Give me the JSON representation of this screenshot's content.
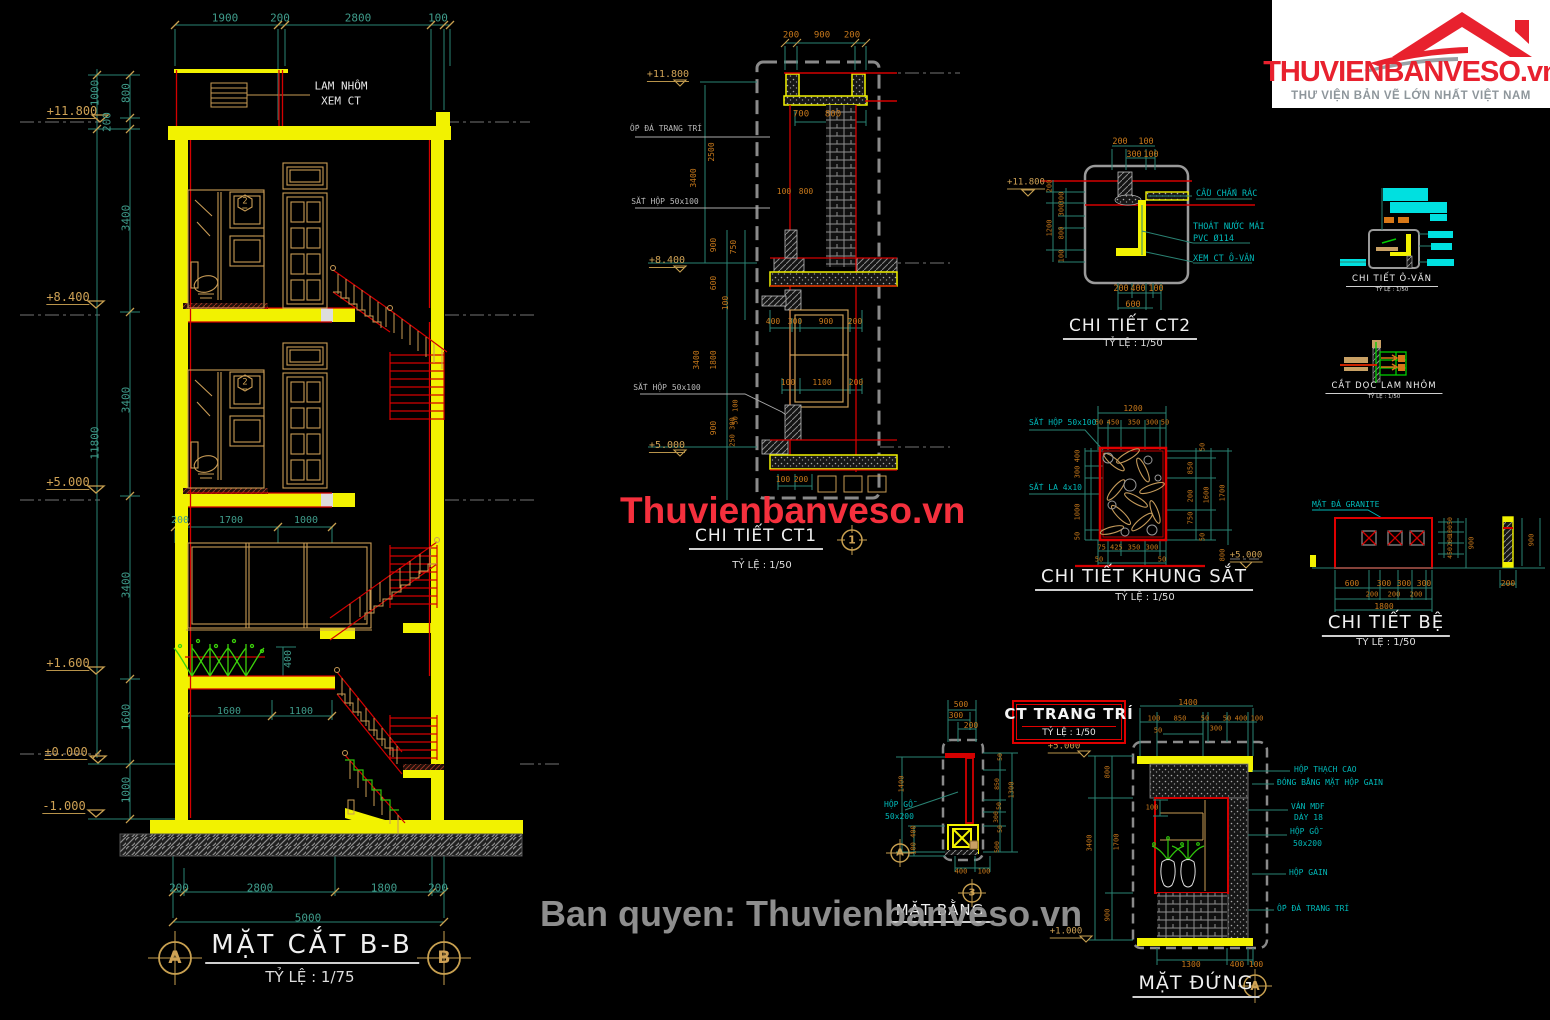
{
  "logo": {
    "brand": "THUVIENBANVESO.vn",
    "tagline": "THƯ VIỆN BẢN VẼ LỚN NHẤT VIỆT NAM"
  },
  "watermarks": {
    "center": "Thuvienbanveso.vn",
    "bottom": "Ban quyen: Thuvienbanveso.vn"
  },
  "colors": {
    "dim_teal": "#3f9c8b",
    "dim_orange": "#c8791b",
    "elevation_tan": "#cfa255",
    "note_cyan": "#00b9b9",
    "structure_yellow": "#f2f200",
    "line_red": "#d40000",
    "brand_red": "#e8212e"
  },
  "drawings": {
    "mat_cat_bb": {
      "title": "MẶT CẮT B-B",
      "scale": "TỶ LỆ : 1/75",
      "grid_a": "A",
      "grid_b": "B"
    },
    "ct1": {
      "title": "CHI TIẾT CT1",
      "scale": "TỶ LỆ : 1/50",
      "marker": "1"
    },
    "ct2": {
      "title": "CHI TIẾT CT2",
      "scale": "TỶ LỆ : 1/50"
    },
    "o_vang": {
      "title": "CHI TIẾT Ô-VĂN",
      "scale": "TỶ LỆ : 1/50"
    },
    "lam_nhom": {
      "title": "CẮT DỌC LAM NHÔM",
      "scale": "TỶ LỆ : 1/50"
    },
    "khung_sat": {
      "title": "CHI TIẾT KHUNG SẮT",
      "scale": "TỶ LỆ : 1/50"
    },
    "be": {
      "title": "CHI TIẾT BỆ",
      "scale": "TỶ LỆ : 1/50"
    },
    "trang_tri": {
      "title": "CT TRANG TRÍ",
      "scale": "TỶ LỆ : 1/50"
    },
    "mat_bang": {
      "title": "MẶT BẰNG",
      "bubble_a": "A",
      "bubble_3": "3"
    },
    "mat_dung": {
      "title": "MẶT ĐỨNG",
      "bubble_a": "A"
    }
  },
  "annotations": [
    {
      "t": "1900",
      "x": 225,
      "y": 18,
      "s": 11
    },
    {
      "t": "200",
      "x": 280,
      "y": 18,
      "s": 11
    },
    {
      "t": "2800",
      "x": 358,
      "y": 18,
      "s": 11
    },
    {
      "t": "100",
      "x": 438,
      "y": 18,
      "s": 11
    },
    {
      "t": "1000",
      "x": 95,
      "y": 93,
      "s": 11,
      "r": -90
    },
    {
      "t": "800",
      "x": 126,
      "y": 93,
      "s": 11,
      "r": -90
    },
    {
      "t": "200",
      "x": 107,
      "y": 122,
      "s": 11,
      "r": -90
    },
    {
      "t": "3400",
      "x": 126,
      "y": 218,
      "s": 11,
      "r": -90
    },
    {
      "t": "3400",
      "x": 126,
      "y": 400,
      "s": 11,
      "r": -90
    },
    {
      "t": "11800",
      "x": 95,
      "y": 443,
      "s": 11,
      "r": -90
    },
    {
      "t": "3400",
      "x": 126,
      "y": 585,
      "s": 11,
      "r": -90
    },
    {
      "t": "1600",
      "x": 126,
      "y": 717,
      "s": 11,
      "r": -90
    },
    {
      "t": "1000",
      "x": 126,
      "y": 790,
      "s": 11,
      "r": -90
    },
    {
      "t": "+11.800",
      "x": 72,
      "y": 112,
      "c": "e",
      "s": 12
    },
    {
      "t": "+8.400",
      "x": 68,
      "y": 298,
      "c": "e",
      "s": 12
    },
    {
      "t": "+5.000",
      "x": 68,
      "y": 483,
      "c": "e",
      "s": 12
    },
    {
      "t": "+1.600",
      "x": 68,
      "y": 664,
      "c": "e",
      "s": 12
    },
    {
      "t": "±0.000",
      "x": 66,
      "y": 753,
      "c": "e",
      "s": 12
    },
    {
      "t": "-1.000",
      "x": 64,
      "y": 807,
      "c": "e",
      "s": 12
    },
    {
      "t": "LAM NHÔM",
      "x": 341,
      "y": 86,
      "c": "w",
      "s": 11
    },
    {
      "t": "XEM CT",
      "x": 341,
      "y": 101,
      "c": "w",
      "s": 11
    },
    {
      "t": "200",
      "x": 180,
      "y": 521
    },
    {
      "t": "1700",
      "x": 231,
      "y": 521
    },
    {
      "t": "1000",
      "x": 306,
      "y": 521
    },
    {
      "t": "400",
      "x": 289,
      "y": 659,
      "r": -90
    },
    {
      "t": "1600",
      "x": 229,
      "y": 712
    },
    {
      "t": "1100",
      "x": 301,
      "y": 712
    },
    {
      "t": "200",
      "x": 179,
      "y": 888,
      "s": 11
    },
    {
      "t": "2800",
      "x": 260,
      "y": 888,
      "s": 11
    },
    {
      "t": "1800",
      "x": 384,
      "y": 888,
      "s": 11
    },
    {
      "t": "200",
      "x": 438,
      "y": 888,
      "s": 11
    },
    {
      "t": "5000",
      "x": 308,
      "y": 918,
      "s": 11
    },
    {
      "t": "2",
      "x": 245,
      "y": 203,
      "c": "e",
      "s": 9
    },
    {
      "t": "2",
      "x": 245,
      "y": 384,
      "c": "e",
      "s": 9
    },
    {
      "t": "200",
      "x": 791,
      "y": 36,
      "c": "o",
      "s": 9
    },
    {
      "t": "900",
      "x": 822,
      "y": 36,
      "c": "o",
      "s": 9
    },
    {
      "t": "200",
      "x": 852,
      "y": 36,
      "c": "o",
      "s": 9
    },
    {
      "t": "+11.800",
      "x": 668,
      "y": 76,
      "c": "e",
      "s": 10
    },
    {
      "t": "ỐP ĐÁ TRANG TRÍ",
      "x": 666,
      "y": 129,
      "c": "g",
      "s": 8
    },
    {
      "t": "700",
      "x": 801,
      "y": 115,
      "c": "o",
      "s": 9
    },
    {
      "t": "800",
      "x": 833,
      "y": 115,
      "c": "o",
      "s": 9
    },
    {
      "t": "100",
      "x": 784,
      "y": 192,
      "c": "o",
      "s": 8
    },
    {
      "t": "800",
      "x": 806,
      "y": 192,
      "c": "o",
      "s": 8
    },
    {
      "t": "2500",
      "x": 712,
      "y": 152,
      "c": "o",
      "s": 8,
      "r": -90
    },
    {
      "t": "3400",
      "x": 694,
      "y": 178,
      "c": "o",
      "s": 8,
      "r": -90
    },
    {
      "t": "SẮT HỘP 50x100",
      "x": 665,
      "y": 202,
      "c": "g",
      "s": 8
    },
    {
      "t": "900",
      "x": 714,
      "y": 245,
      "c": "o",
      "s": 8,
      "r": -90
    },
    {
      "t": "750",
      "x": 734,
      "y": 247,
      "c": "o",
      "s": 8,
      "r": -90
    },
    {
      "t": "+8.400",
      "x": 667,
      "y": 262,
      "c": "e",
      "s": 10
    },
    {
      "t": "600",
      "x": 714,
      "y": 283,
      "c": "o",
      "s": 8,
      "r": -90
    },
    {
      "t": "100",
      "x": 726,
      "y": 303,
      "c": "o",
      "s": 8,
      "r": -90
    },
    {
      "t": "400",
      "x": 773,
      "y": 322,
      "c": "o",
      "s": 8
    },
    {
      "t": "300",
      "x": 795,
      "y": 322,
      "c": "o",
      "s": 8
    },
    {
      "t": "900",
      "x": 826,
      "y": 322,
      "c": "o",
      "s": 8
    },
    {
      "t": "200",
      "x": 855,
      "y": 322,
      "c": "o",
      "s": 8
    },
    {
      "t": "3400",
      "x": 697,
      "y": 360,
      "c": "o",
      "s": 8,
      "r": -90
    },
    {
      "t": "1800",
      "x": 714,
      "y": 360,
      "c": "o",
      "s": 8,
      "r": -90
    },
    {
      "t": "SẮT HỘP 50x100",
      "x": 667,
      "y": 388,
      "c": "g",
      "s": 8
    },
    {
      "t": "100",
      "x": 788,
      "y": 383,
      "c": "o",
      "s": 8
    },
    {
      "t": "1100",
      "x": 822,
      "y": 383,
      "c": "o",
      "s": 8
    },
    {
      "t": "200",
      "x": 856,
      "y": 383,
      "c": "o",
      "s": 8
    },
    {
      "t": "50 100",
      "x": 736,
      "y": 412,
      "c": "o",
      "s": 7,
      "r": -90
    },
    {
      "t": "900",
      "x": 714,
      "y": 428,
      "c": "o",
      "s": 8,
      "r": -90
    },
    {
      "t": "250 300",
      "x": 733,
      "y": 432,
      "c": "o",
      "s": 7,
      "r": -90
    },
    {
      "t": "+5.000",
      "x": 667,
      "y": 447,
      "c": "e",
      "s": 10
    },
    {
      "t": "100",
      "x": 783,
      "y": 480,
      "c": "o",
      "s": 8
    },
    {
      "t": "200",
      "x": 801,
      "y": 480,
      "c": "o",
      "s": 8
    },
    {
      "t": "200",
      "x": 1120,
      "y": 142,
      "c": "o",
      "s": 8.5
    },
    {
      "t": "100",
      "x": 1146,
      "y": 142,
      "c": "o",
      "s": 8.5
    },
    {
      "t": "300",
      "x": 1134,
      "y": 155,
      "c": "o",
      "s": 8.5
    },
    {
      "t": "100",
      "x": 1151,
      "y": 155,
      "c": "o",
      "s": 8.5
    },
    {
      "t": "+11.800",
      "x": 1026,
      "y": 184,
      "c": "e",
      "s": 9
    },
    {
      "t": "200",
      "x": 1050,
      "y": 186,
      "c": "o",
      "s": 7,
      "r": -90
    },
    {
      "t": "300",
      "x": 1062,
      "y": 198,
      "c": "o",
      "s": 7,
      "r": -90
    },
    {
      "t": "300",
      "x": 1062,
      "y": 210,
      "c": "o",
      "s": 7,
      "r": -90
    },
    {
      "t": "1200",
      "x": 1050,
      "y": 228,
      "c": "o",
      "s": 7,
      "r": -90
    },
    {
      "t": "800",
      "x": 1062,
      "y": 233,
      "c": "o",
      "s": 7,
      "r": -90
    },
    {
      "t": "100",
      "x": 1062,
      "y": 256,
      "c": "o",
      "s": 7,
      "r": -90
    },
    {
      "t": "200",
      "x": 1121,
      "y": 289,
      "c": "o",
      "s": 8.5
    },
    {
      "t": "400",
      "x": 1138,
      "y": 289,
      "c": "o",
      "s": 8.5
    },
    {
      "t": "100",
      "x": 1156,
      "y": 289,
      "c": "o",
      "s": 8.5
    },
    {
      "t": "600",
      "x": 1133,
      "y": 305,
      "c": "o",
      "s": 8.5
    },
    {
      "t": "CẦU CHẮN RÁC",
      "x": 1196,
      "y": 194,
      "c": "n",
      "s": 8.5,
      "a": "l"
    },
    {
      "t": "THOÁT NƯỚC MÁI",
      "x": 1193,
      "y": 227,
      "c": "n",
      "s": 8.5,
      "a": "l"
    },
    {
      "t": "PVC Ø114",
      "x": 1193,
      "y": 239,
      "c": "n",
      "s": 8.5,
      "a": "l"
    },
    {
      "t": "XEM CT Ô-VĂN",
      "x": 1193,
      "y": 259,
      "c": "n",
      "s": 8.5,
      "a": "l"
    },
    {
      "t": "1200",
      "x": 1133,
      "y": 409,
      "c": "o",
      "s": 8
    },
    {
      "t": "50",
      "x": 1099,
      "y": 423,
      "c": "o",
      "s": 7
    },
    {
      "t": "450",
      "x": 1113,
      "y": 423,
      "c": "o",
      "s": 7
    },
    {
      "t": "350",
      "x": 1134,
      "y": 423,
      "c": "o",
      "s": 7
    },
    {
      "t": "300",
      "x": 1152,
      "y": 423,
      "c": "o",
      "s": 7
    },
    {
      "t": "50",
      "x": 1165,
      "y": 423,
      "c": "o",
      "s": 7
    },
    {
      "t": "SẮT HỘP 50x100",
      "x": 1029,
      "y": 423,
      "c": "n",
      "s": 8,
      "a": "l"
    },
    {
      "t": "SẮT LA 4x10",
      "x": 1029,
      "y": 488,
      "c": "n",
      "s": 8,
      "a": "l"
    },
    {
      "t": "400",
      "x": 1078,
      "y": 456,
      "c": "o",
      "s": 7,
      "r": -90
    },
    {
      "t": "300",
      "x": 1078,
      "y": 472,
      "c": "o",
      "s": 7,
      "r": -90
    },
    {
      "t": "1000",
      "x": 1078,
      "y": 512,
      "c": "o",
      "s": 7,
      "r": -90
    },
    {
      "t": "50",
      "x": 1078,
      "y": 536,
      "c": "o",
      "s": 7,
      "r": -90
    },
    {
      "t": "50",
      "x": 1203,
      "y": 447,
      "c": "o",
      "s": 7,
      "r": -90
    },
    {
      "t": "850",
      "x": 1191,
      "y": 468,
      "c": "o",
      "s": 7,
      "r": -90
    },
    {
      "t": "200",
      "x": 1191,
      "y": 496,
      "c": "o",
      "s": 7,
      "r": -90
    },
    {
      "t": "750",
      "x": 1191,
      "y": 518,
      "c": "o",
      "s": 7,
      "r": -90
    },
    {
      "t": "50",
      "x": 1203,
      "y": 537,
      "c": "o",
      "s": 7,
      "r": -90
    },
    {
      "t": "1600",
      "x": 1207,
      "y": 495,
      "c": "o",
      "s": 7,
      "r": -90
    },
    {
      "t": "1700",
      "x": 1223,
      "y": 493,
      "c": "o",
      "s": 7,
      "r": -90
    },
    {
      "t": "800",
      "x": 1223,
      "y": 555,
      "c": "o",
      "s": 7,
      "r": -90
    },
    {
      "t": "75 425",
      "x": 1110,
      "y": 548,
      "c": "o",
      "s": 7
    },
    {
      "t": "350",
      "x": 1134,
      "y": 548,
      "c": "o",
      "s": 7
    },
    {
      "t": "300",
      "x": 1152,
      "y": 548,
      "c": "o",
      "s": 7
    },
    {
      "t": "50",
      "x": 1099,
      "y": 560,
      "c": "o",
      "s": 7
    },
    {
      "t": "50",
      "x": 1162,
      "y": 560,
      "c": "o",
      "s": 7
    },
    {
      "t": "+5.000",
      "x": 1246,
      "y": 557,
      "c": "e",
      "s": 9
    },
    {
      "t": "MẶT ĐÁ GRANITE",
      "x": 1312,
      "y": 505,
      "c": "n",
      "s": 8,
      "a": "l"
    },
    {
      "t": "600",
      "x": 1352,
      "y": 584,
      "c": "o",
      "s": 8
    },
    {
      "t": "300",
      "x": 1384,
      "y": 584,
      "c": "o",
      "s": 8
    },
    {
      "t": "300",
      "x": 1404,
      "y": 584,
      "c": "o",
      "s": 8
    },
    {
      "t": "300",
      "x": 1424,
      "y": 584,
      "c": "o",
      "s": 8
    },
    {
      "t": "200",
      "x": 1372,
      "y": 595,
      "c": "o",
      "s": 7
    },
    {
      "t": "200",
      "x": 1394,
      "y": 595,
      "c": "o",
      "s": 7
    },
    {
      "t": "200",
      "x": 1416,
      "y": 595,
      "c": "o",
      "s": 7
    },
    {
      "t": "1800",
      "x": 1384,
      "y": 607,
      "c": "o",
      "s": 8
    },
    {
      "t": "50",
      "x": 1450,
      "y": 521,
      "c": "o",
      "s": 6.5,
      "r": -90
    },
    {
      "t": "100",
      "x": 1450,
      "y": 531,
      "c": "o",
      "s": 6.5,
      "r": -90
    },
    {
      "t": "200",
      "x": 1450,
      "y": 541,
      "c": "o",
      "s": 6.5,
      "r": -90
    },
    {
      "t": "450",
      "x": 1450,
      "y": 553,
      "c": "o",
      "s": 6.5,
      "r": -90
    },
    {
      "t": "900",
      "x": 1472,
      "y": 543,
      "c": "o",
      "s": 7,
      "r": -90
    },
    {
      "t": "200",
      "x": 1508,
      "y": 584,
      "c": "o",
      "s": 8
    },
    {
      "t": "900",
      "x": 1532,
      "y": 540,
      "c": "o",
      "s": 7,
      "r": -90
    },
    {
      "t": "500",
      "x": 961,
      "y": 705,
      "c": "o",
      "s": 8
    },
    {
      "t": "300",
      "x": 956,
      "y": 716,
      "c": "o",
      "s": 8
    },
    {
      "t": "200",
      "x": 971,
      "y": 726,
      "c": "o",
      "s": 8
    },
    {
      "t": "1400",
      "x": 902,
      "y": 784,
      "c": "o",
      "s": 7,
      "r": -90
    },
    {
      "t": "100 400",
      "x": 914,
      "y": 840,
      "c": "o",
      "s": 7,
      "r": -90
    },
    {
      "t": "50",
      "x": 1000,
      "y": 757,
      "c": "o",
      "s": 6.5,
      "r": -90
    },
    {
      "t": "850",
      "x": 997,
      "y": 784,
      "c": "o",
      "s": 6.5,
      "r": -90
    },
    {
      "t": "1300",
      "x": 1012,
      "y": 790,
      "c": "o",
      "s": 7,
      "r": -90
    },
    {
      "t": "50",
      "x": 999,
      "y": 806,
      "c": "o",
      "s": 6.5,
      "r": -90
    },
    {
      "t": "300",
      "x": 996,
      "y": 817,
      "c": "o",
      "s": 6.5,
      "r": -90
    },
    {
      "t": "50",
      "x": 1000,
      "y": 829,
      "c": "o",
      "s": 6.5,
      "r": -90
    },
    {
      "t": "500",
      "x": 997,
      "y": 847,
      "c": "o",
      "s": 6.5,
      "r": -90
    },
    {
      "t": "400",
      "x": 961,
      "y": 872,
      "c": "o",
      "s": 7
    },
    {
      "t": "100",
      "x": 984,
      "y": 872,
      "c": "o",
      "s": 7
    },
    {
      "t": "HỘP GỖ",
      "x": 884,
      "y": 805,
      "c": "n",
      "s": 8,
      "a": "l"
    },
    {
      "t": "50x200",
      "x": 885,
      "y": 817,
      "c": "n",
      "s": 8,
      "a": "l"
    },
    {
      "t": "+5.000",
      "x": 1064,
      "y": 748,
      "c": "e",
      "s": 9
    },
    {
      "t": "+1.000",
      "x": 1066,
      "y": 933,
      "c": "e",
      "s": 9
    },
    {
      "t": "800",
      "x": 1108,
      "y": 772,
      "c": "o",
      "s": 7,
      "r": -90
    },
    {
      "t": "3400",
      "x": 1090,
      "y": 843,
      "c": "o",
      "s": 7,
      "r": -90
    },
    {
      "t": "1700",
      "x": 1117,
      "y": 842,
      "c": "o",
      "s": 7,
      "r": -90
    },
    {
      "t": "900",
      "x": 1108,
      "y": 915,
      "c": "o",
      "s": 7,
      "r": -90
    },
    {
      "t": "1400",
      "x": 1188,
      "y": 703,
      "c": "o",
      "s": 8
    },
    {
      "t": "100",
      "x": 1154,
      "y": 719,
      "c": "o",
      "s": 7
    },
    {
      "t": "850",
      "x": 1180,
      "y": 719,
      "c": "o",
      "s": 7
    },
    {
      "t": "50",
      "x": 1205,
      "y": 719,
      "c": "o",
      "s": 7
    },
    {
      "t": "50",
      "x": 1227,
      "y": 719,
      "c": "o",
      "s": 7
    },
    {
      "t": "400",
      "x": 1241,
      "y": 719,
      "c": "o",
      "s": 7
    },
    {
      "t": "100",
      "x": 1257,
      "y": 719,
      "c": "o",
      "s": 7
    },
    {
      "t": "50",
      "x": 1158,
      "y": 731,
      "c": "o",
      "s": 7
    },
    {
      "t": "300",
      "x": 1216,
      "y": 729,
      "c": "o",
      "s": 7
    },
    {
      "t": "100",
      "x": 1152,
      "y": 808,
      "c": "o",
      "s": 7
    },
    {
      "t": "HỘP THẠCH CAO",
      "x": 1294,
      "y": 770,
      "c": "n",
      "s": 8,
      "a": "l"
    },
    {
      "t": "ĐÓNG BẰNG MẶT HỘP GAIN",
      "x": 1277,
      "y": 783,
      "c": "n",
      "s": 8,
      "a": "l"
    },
    {
      "t": "VÁN MDF",
      "x": 1291,
      "y": 807,
      "c": "n",
      "s": 8,
      "a": "l"
    },
    {
      "t": "DÀY 18",
      "x": 1294,
      "y": 818,
      "c": "n",
      "s": 8,
      "a": "l"
    },
    {
      "t": "HỘP GỖ",
      "x": 1290,
      "y": 832,
      "c": "n",
      "s": 8,
      "a": "l"
    },
    {
      "t": "50x200",
      "x": 1293,
      "y": 844,
      "c": "n",
      "s": 8,
      "a": "l"
    },
    {
      "t": "HỘP GAIN",
      "x": 1289,
      "y": 873,
      "c": "n",
      "s": 8,
      "a": "l"
    },
    {
      "t": "ỐP ĐÁ TRANG TRÍ",
      "x": 1277,
      "y": 909,
      "c": "n",
      "s": 8,
      "a": "l"
    },
    {
      "t": "1300",
      "x": 1191,
      "y": 965,
      "c": "o",
      "s": 8
    },
    {
      "t": "400",
      "x": 1237,
      "y": 965,
      "c": "o",
      "s": 8
    },
    {
      "t": "100",
      "x": 1256,
      "y": 965,
      "c": "o",
      "s": 8
    }
  ]
}
